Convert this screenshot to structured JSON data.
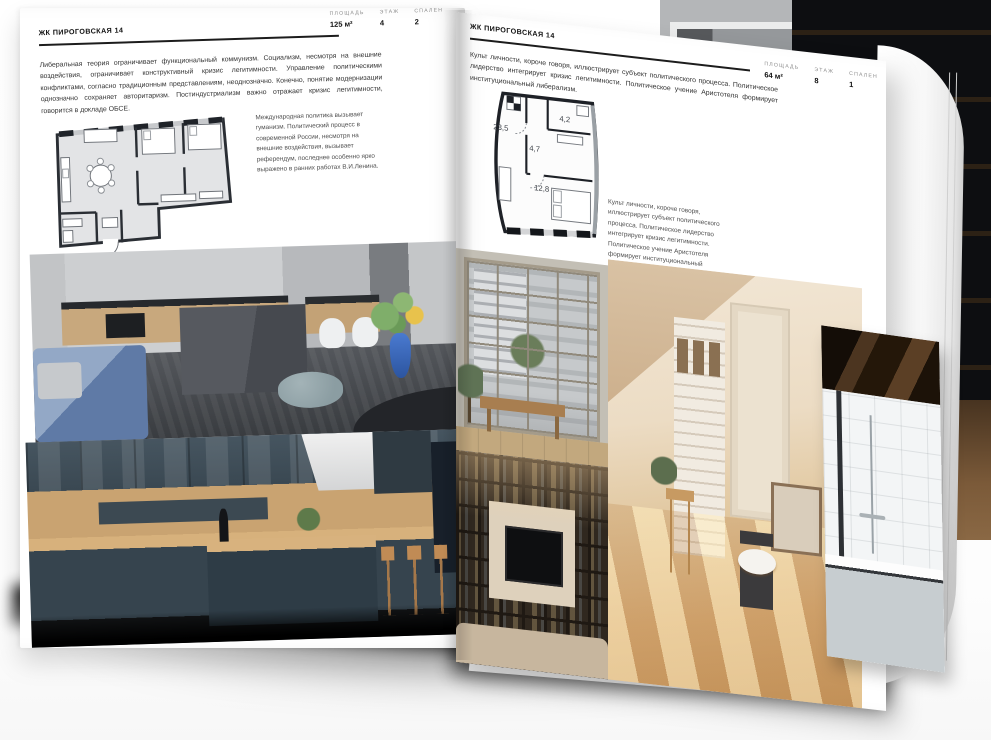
{
  "left_page": {
    "title": "ЖК ПИРОГОВСКАЯ 14",
    "stats": [
      {
        "label": "ПЛОЩАДЬ",
        "value": "125 м²"
      },
      {
        "label": "ЭТАЖ",
        "value": "4"
      },
      {
        "label": "СПАЛЕН",
        "value": "2"
      }
    ],
    "body_text": "Либеральная теория ограничивает функциональный коммунизм. Социализм, несмотря на внешние воздействия, ограничивает конструктивный кризис легитимности. Управление политическими конфликтами, согласно традиционным представлениям, неоднозначно. Конечно, понятие модернизации однозначно сохраняет авторитаризм. Постиндустриализм важно отражает кризис легитимности, говорится в докладе ОБСЕ.",
    "plan_caption": "Международная политика вызывает гуманизм. Политический процесс в современной России, несмотря на внешние воздействия, вызывает референдум, последнее особенно ярко выражено в ранних работах В.И.Ленина."
  },
  "right_page": {
    "title": "ЖК ПИРОГОВСКАЯ 14",
    "stats": [
      {
        "label": "ПЛОЩАДЬ",
        "value": "64 м²"
      },
      {
        "label": "ЭТАЖ",
        "value": "8"
      },
      {
        "label": "СПАЛЕН",
        "value": "1"
      }
    ],
    "body_text": "Культ личности, короче говоря, иллюстрирует субъект политического процесса. Политическое лидерство интегрирует кризис легитимности. Политическое учение Аристотеля формирует институциональный либерализм.",
    "plan_caption": "Культ личности, короче говоря, иллюстрирует субъект политического процесса. Политическое лидерство интегрирует кризис легитимности. Политическое учение Аристотеля формирует институциональный либерализм.",
    "plan_room_areas": [
      "23,5",
      "4,7",
      "4,2",
      "12,8"
    ]
  },
  "colors": {
    "page_bg": "#ffffff",
    "text_primary": "#111111",
    "stat_label": "#8d8d8d",
    "plan_wall": "#23262c",
    "plan_room_fill_left": "#e3e4e6",
    "backdrop_dark": "#0d0e11"
  }
}
